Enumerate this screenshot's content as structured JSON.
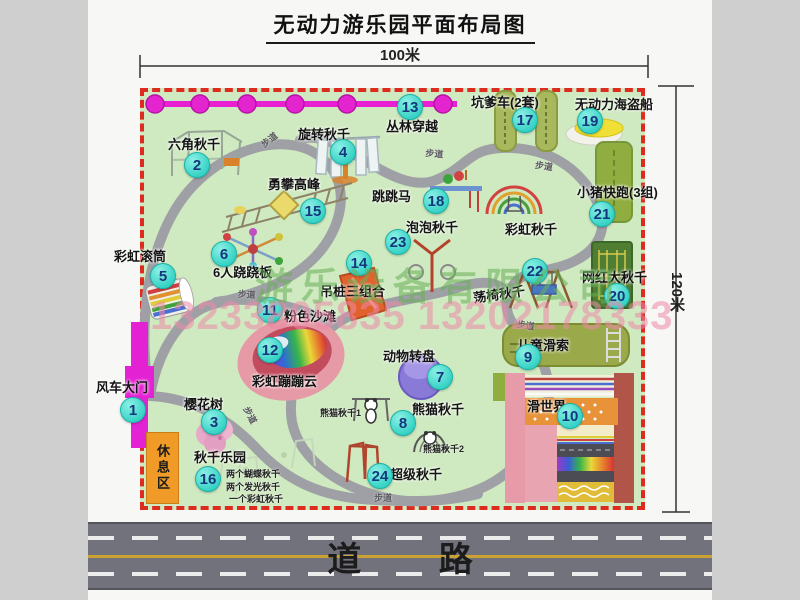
{
  "title": "无动力游乐园平面布局图",
  "dimensions": {
    "width_label": "100米",
    "height_label": "120米"
  },
  "road": {
    "label": "道 路"
  },
  "watermark": {
    "company": "游乐设备有限公司",
    "phone": "13233805835 13202178333"
  },
  "rest_area_label": "休息区",
  "colors": {
    "park_green": "#cfe9c0",
    "border_red": "#dd2b20",
    "badge_fill": "#35d2c5",
    "badge_text": "#14377e",
    "gate_magenta": "#e322d3",
    "walkway_gray": "#9fa0a6",
    "rest_orange": "#f09a28",
    "road_gray": "#72727c",
    "watermark_green": "#69af58",
    "watermark_pink": "#ee89a9"
  },
  "park": {
    "walkway_text": "步道",
    "attractions": [
      {
        "num": "1",
        "name": "风车大门",
        "label": [
          96,
          377
        ],
        "badge": [
          133,
          410
        ]
      },
      {
        "num": "2",
        "name": "六角秋千",
        "label": [
          168,
          134
        ],
        "badge": [
          197,
          165
        ]
      },
      {
        "num": "3",
        "name": "樱花树",
        "label": [
          184,
          394
        ],
        "badge": [
          214,
          422
        ]
      },
      {
        "num": "4",
        "name": "旋转秋千",
        "label": [
          298,
          124
        ],
        "badge": [
          343,
          152
        ]
      },
      {
        "num": "5",
        "name": "彩虹滚筒",
        "label": [
          114,
          246
        ],
        "badge": [
          163,
          276
        ]
      },
      {
        "num": "6",
        "name": "6人跷跷板",
        "label": [
          213,
          262
        ],
        "badge": [
          224,
          254
        ]
      },
      {
        "num": "7",
        "name": "动物转盘",
        "label": [
          383,
          346
        ],
        "badge": [
          440,
          377
        ]
      },
      {
        "num": "8",
        "name": "熊猫秋千",
        "label": [
          412,
          399
        ],
        "badge": [
          403,
          423
        ]
      },
      {
        "num": "9",
        "name": "儿童滑索",
        "label": [
          517,
          335
        ],
        "badge": [
          528,
          357
        ]
      },
      {
        "num": "10",
        "name": "滑世界",
        "label": [
          527,
          396
        ],
        "badge": [
          570,
          416
        ]
      },
      {
        "num": "11",
        "name": "粉色沙滩",
        "label": [
          284,
          306
        ],
        "badge": [
          270,
          310
        ]
      },
      {
        "num": "12",
        "name": "彩虹蹦蹦云",
        "label": [
          252,
          371
        ],
        "badge": [
          270,
          350
        ]
      },
      {
        "num": "13",
        "name": "丛林穿越",
        "label": [
          386,
          116
        ],
        "badge": [
          410,
          107
        ]
      },
      {
        "num": "14",
        "name": "吊桩三组合",
        "label": [
          320,
          281
        ],
        "badge": [
          359,
          263
        ]
      },
      {
        "num": "15",
        "name": "勇攀高峰",
        "label": [
          268,
          174
        ],
        "badge": [
          313,
          211
        ]
      },
      {
        "num": "16",
        "name": "秋千乐园",
        "label": [
          194,
          447
        ],
        "badge": [
          208,
          479
        ]
      },
      {
        "num": "17",
        "name": "坑爹车(2套)",
        "label": [
          471,
          92
        ],
        "badge": [
          525,
          120
        ]
      },
      {
        "num": "18",
        "name": "跳跳马",
        "label": [
          372,
          186
        ],
        "badge": [
          436,
          201
        ]
      },
      {
        "num": "19",
        "name": "无动力海盗船",
        "label": [
          575,
          94
        ],
        "badge": [
          590,
          121
        ]
      },
      {
        "num": "20",
        "name": "网红大秋千",
        "label": [
          582,
          267
        ],
        "badge": [
          617,
          296
        ]
      },
      {
        "num": "21",
        "name": "小猪快跑(3组)",
        "label": [
          577,
          182
        ],
        "badge": [
          602,
          214
        ]
      },
      {
        "num": "22",
        "name": "荡椅秋千",
        "label": [
          473,
          284
        ],
        "badge": [
          535,
          271
        ],
        "rot": -8
      },
      {
        "num": "23",
        "name": "泡泡秋千",
        "label": [
          406,
          217
        ],
        "badge": [
          398,
          242
        ]
      },
      {
        "num": "24",
        "name": "超级秋千",
        "label": [
          390,
          464
        ],
        "badge": [
          380,
          476
        ]
      },
      {
        "name": "彩虹秋千",
        "label": [
          505,
          219
        ]
      }
    ],
    "sub_labels": [
      {
        "text": "熊猫秋千1",
        "pos": [
          320,
          406
        ]
      },
      {
        "text": "熊猫秋千2",
        "pos": [
          423,
          442
        ]
      },
      {
        "text": "两个蝴蝶秋千",
        "pos": [
          226,
          467
        ]
      },
      {
        "text": "两个发光秋千",
        "pos": [
          226,
          480
        ]
      },
      {
        "text": "一个彩虹秋千",
        "pos": [
          229,
          492
        ]
      }
    ],
    "walkway_labels": [
      [
        258,
        140,
        -38
      ],
      [
        426,
        146,
        5
      ],
      [
        536,
        158,
        8
      ],
      [
        238,
        287,
        3
      ],
      [
        252,
        404,
        62
      ],
      [
        518,
        317,
        10
      ],
      [
        374,
        491,
        0
      ]
    ]
  }
}
